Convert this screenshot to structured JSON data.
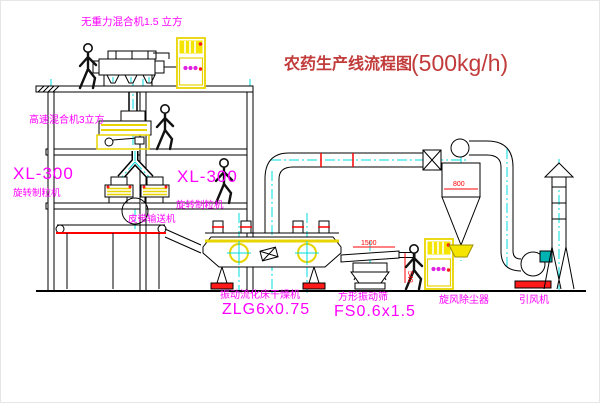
{
  "title": {
    "name": "农药生产线流程图",
    "capacity": "(500kg/h)"
  },
  "equipment": {
    "gravity_mixer": {
      "label": "无重力混合机1.5 立方"
    },
    "high_speed_mixer": {
      "label": "高速混合机3立方"
    },
    "granulator_left": {
      "model": "XL-300",
      "name": "旋转制粒机"
    },
    "granulator_right": {
      "model": "XL-300",
      "name": "旋转制粒机"
    },
    "belt_conveyor": {
      "label": "皮带输送机"
    },
    "fluid_bed_dryer": {
      "name": "振动流化床干燥机",
      "model": "ZLG6x0.75"
    },
    "square_sieve": {
      "name": "方形振动筛",
      "model": "FS0.6x1.5"
    },
    "cyclone": {
      "label": "旋风除尘器"
    },
    "fan": {
      "label": "引风机"
    }
  },
  "dimensions": {
    "cyclone_width": "800",
    "sieve_length": "1500",
    "sieve_height": "540"
  },
  "colors": {
    "label_magenta": "#ff00ff",
    "title_red": "#c23b3b",
    "dimension_red": "#ff0000",
    "outline_black": "#000000",
    "accent_yellow": "#f5e400",
    "centerline_cyan": "#00dcdc",
    "motor_teal": "#00b3b3"
  }
}
